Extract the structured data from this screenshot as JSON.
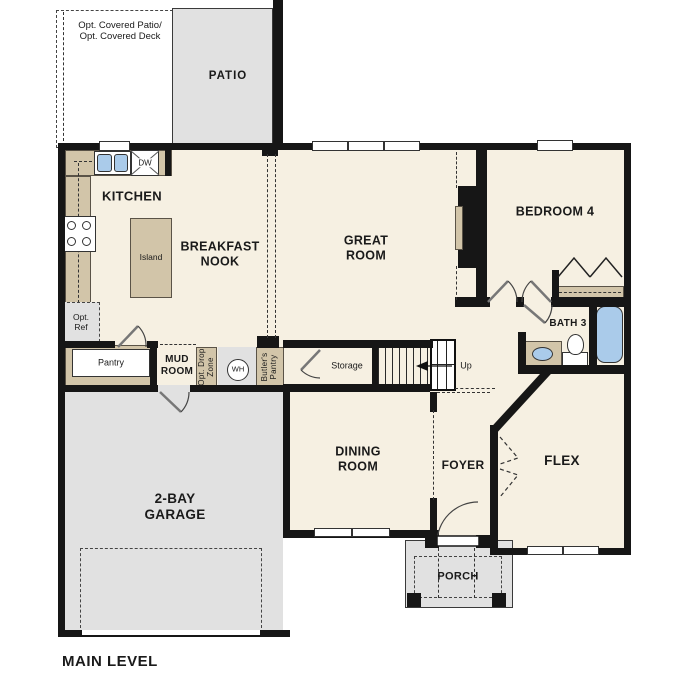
{
  "plan": {
    "level": "MAIN LEVEL",
    "areas": {
      "opt_patio": "Opt. Covered Patio/\nOpt. Covered Deck",
      "patio": "PATIO",
      "kitchen": "KITCHEN",
      "breakfast_nook": "BREAKFAST\nNOOK",
      "great_room": "GREAT\nROOM",
      "bedroom4": "BEDROOM 4",
      "bath3": "BATH 3",
      "mud_room": "MUD\nROOM",
      "garage": "2-BAY\nGARAGE",
      "dining": "DINING\nROOM",
      "foyer": "FOYER",
      "flex": "FLEX",
      "porch": "PORCH"
    },
    "features": {
      "island": "Island",
      "pantry": "Pantry",
      "storage": "Storage",
      "opt_ref": "Opt.\nRef",
      "dishwasher": "DW",
      "water_heater": "WH",
      "drop_zone": "Opt. Drop\nZone",
      "butlers_pantry": "Butler's\nPantry",
      "up": "Up"
    },
    "colors": {
      "floor": "#f6f0e2",
      "wall": "#161616",
      "cabinetry": "#d2c5a9",
      "concrete": "#e1e1e1",
      "water_fixture": "#aacbea"
    }
  }
}
